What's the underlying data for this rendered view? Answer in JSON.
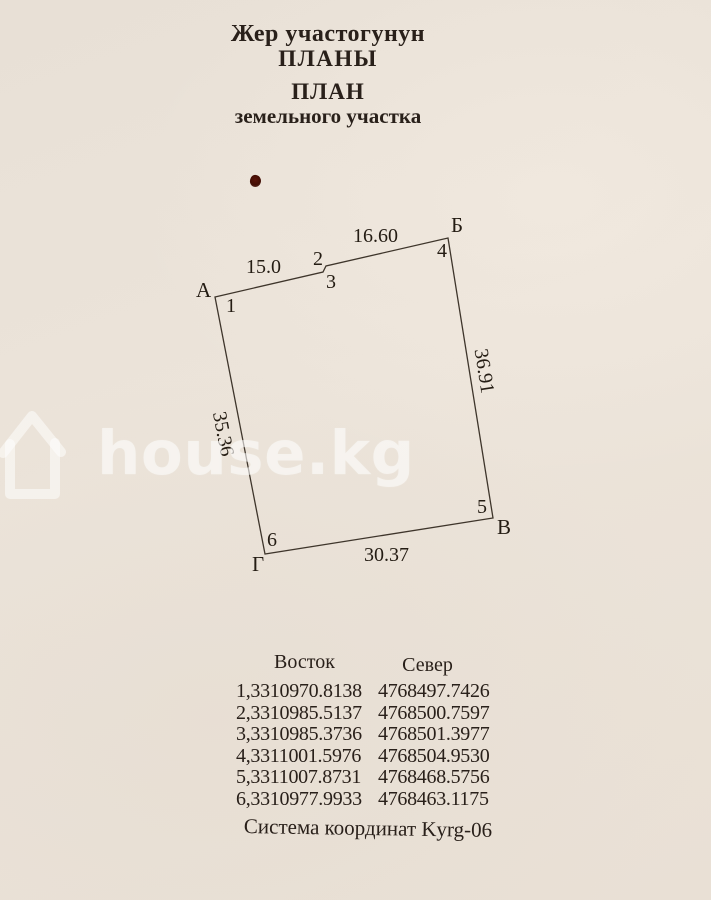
{
  "title": {
    "kyrgyz_line1": "Жер участогунун",
    "kyrgyz_line2": "ПЛАНЫ",
    "russian_line1": "ПЛАН",
    "russian_line2": "земельного участка"
  },
  "plan": {
    "corners": {
      "a": "А",
      "b": "Б",
      "v": "В",
      "g": "Г"
    },
    "vertices": {
      "v1": "1",
      "v2": "2",
      "v3": "3",
      "v4": "4",
      "v5": "5",
      "v6": "6"
    },
    "sides": {
      "s1_2": "15.0",
      "s3_4": "16.60",
      "s4_5": "36.91",
      "s5_6": "30.37",
      "s6_1": "35.36"
    }
  },
  "table": {
    "header": {
      "east": "Восток",
      "north": "Север"
    },
    "rows": [
      [
        "1,3310970.8138",
        "4768497.7426"
      ],
      [
        "2,3310985.5137",
        "4768500.7597"
      ],
      [
        "3,3310985.3736",
        "4768501.3977"
      ],
      [
        "4,3311001.5976",
        "4768504.9530"
      ],
      [
        "5,3311007.8731",
        "4768468.5756"
      ],
      [
        "6,3310977.9933",
        "4768463.1175"
      ]
    ]
  },
  "footer": {
    "coordinate_system": "Система координат Kyrg-06"
  },
  "watermark": {
    "text": "house.kg"
  }
}
